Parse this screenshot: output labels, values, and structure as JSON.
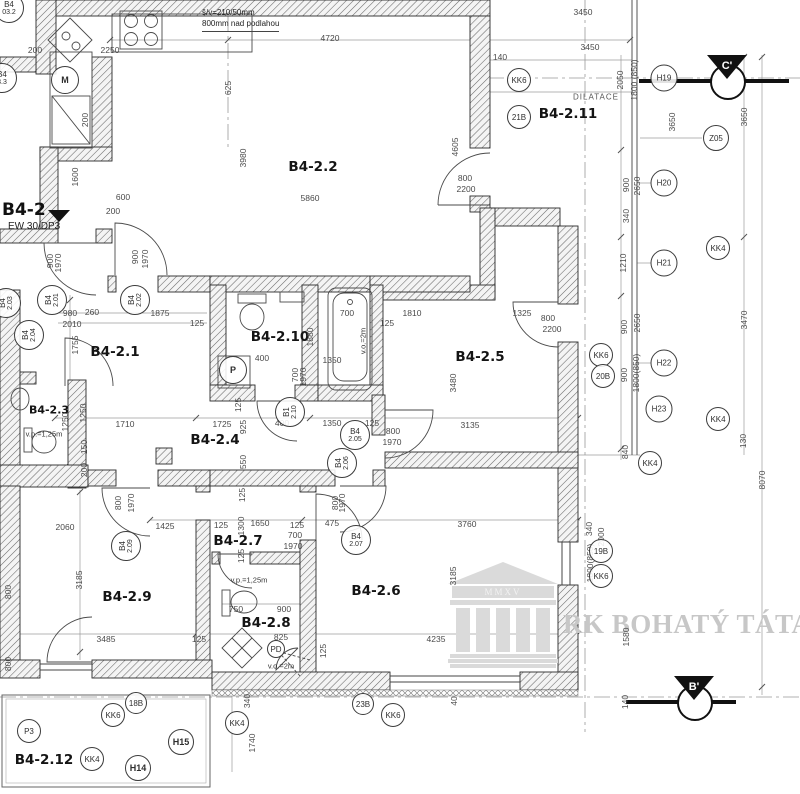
{
  "title": {
    "label": "B4-2",
    "fire_rating": "EW 30/DP3"
  },
  "note": {
    "line1": "š/v=210/50mm",
    "line2": "800mm nad podlahou"
  },
  "watermark": {
    "text": "RK BOHATÝ TÁTA",
    "inscription": "MMXV"
  },
  "section_markers": {
    "c": "C'",
    "b": "B'"
  },
  "rooms": [
    {
      "name": "room-label-b4-2-1",
      "text": "B4-2.1",
      "x": 115,
      "y": 352
    },
    {
      "name": "room-label-b4-2-2",
      "text": "B4-2.2",
      "x": 313,
      "y": 167
    },
    {
      "name": "room-label-b4-2-3",
      "text": "B4-2.3",
      "x": 49,
      "y": 410,
      "cls": "room-sm"
    },
    {
      "name": "room-label-b4-2-4",
      "text": "B4-2.4",
      "x": 215,
      "y": 440
    },
    {
      "name": "room-label-b4-2-5",
      "text": "B4-2.5",
      "x": 480,
      "y": 357
    },
    {
      "name": "room-label-b4-2-6",
      "text": "B4-2.6",
      "x": 376,
      "y": 591
    },
    {
      "name": "room-label-b4-2-7",
      "text": "B4-2.7",
      "x": 238,
      "y": 541
    },
    {
      "name": "room-label-b4-2-8",
      "text": "B4-2.8",
      "x": 266,
      "y": 623
    },
    {
      "name": "room-label-b4-2-9",
      "text": "B4-2.9",
      "x": 127,
      "y": 597
    },
    {
      "name": "room-label-b4-2-10",
      "text": "B4-2.10",
      "x": 280,
      "y": 337
    },
    {
      "name": "room-label-b4-2-11",
      "text": "B4-2.11",
      "x": 568,
      "y": 114
    },
    {
      "name": "room-label-b4-2-12",
      "text": "B4-2.12",
      "x": 44,
      "y": 760
    }
  ],
  "texts": [
    {
      "text": "DILATACE",
      "x": 596,
      "y": 97,
      "cls": "dilat"
    },
    {
      "text": "v.o.=2m",
      "x": 363,
      "y": 341,
      "rot": -90,
      "cls": "small"
    },
    {
      "text": "v.p.=1,25m",
      "x": 44,
      "y": 434,
      "cls": "small"
    },
    {
      "text": "v.p.=1,25m",
      "x": 249,
      "y": 580,
      "cls": "small"
    },
    {
      "text": "v.o.=2m",
      "x": 281,
      "y": 666,
      "cls": "small"
    }
  ],
  "dims": [
    {
      "text": "4720",
      "x": 330,
      "y": 38
    },
    {
      "text": "3450",
      "x": 583,
      "y": 12
    },
    {
      "text": "3450",
      "x": 590,
      "y": 47
    },
    {
      "text": "140",
      "x": 500,
      "y": 57
    },
    {
      "text": "2250",
      "x": 110,
      "y": 50
    },
    {
      "text": "200",
      "x": 35,
      "y": 50
    },
    {
      "text": "625",
      "x": 228,
      "y": 88,
      "rot": -90
    },
    {
      "text": "200",
      "x": 85,
      "y": 120,
      "rot": -90
    },
    {
      "text": "1600",
      "x": 75,
      "y": 177,
      "rot": -90
    },
    {
      "text": "600",
      "x": 123,
      "y": 197
    },
    {
      "text": "200",
      "x": 113,
      "y": 211
    },
    {
      "text": "5860",
      "x": 310,
      "y": 198
    },
    {
      "text": "3980",
      "x": 243,
      "y": 158,
      "rot": -90
    },
    {
      "text": "4605",
      "x": 455,
      "y": 147,
      "rot": -90
    },
    {
      "text": "800",
      "x": 465,
      "y": 178
    },
    {
      "text": "2200",
      "x": 466,
      "y": 189
    },
    {
      "text": "900",
      "x": 50,
      "y": 261,
      "rot": -90
    },
    {
      "text": "1970",
      "x": 58,
      "y": 263,
      "rot": -90
    },
    {
      "text": "900",
      "x": 135,
      "y": 257,
      "rot": -90
    },
    {
      "text": "1970",
      "x": 145,
      "y": 259,
      "rot": -90
    },
    {
      "text": "980",
      "x": 70,
      "y": 313
    },
    {
      "text": "260",
      "x": 92,
      "y": 312
    },
    {
      "text": "2010",
      "x": 72,
      "y": 324
    },
    {
      "text": "1875",
      "x": 160,
      "y": 313
    },
    {
      "text": "125",
      "x": 197,
      "y": 323
    },
    {
      "text": "1755",
      "x": 75,
      "y": 345,
      "rot": -90
    },
    {
      "text": "700",
      "x": 347,
      "y": 313
    },
    {
      "text": "1810",
      "x": 412,
      "y": 313
    },
    {
      "text": "125",
      "x": 387,
      "y": 323
    },
    {
      "text": "1880",
      "x": 310,
      "y": 337,
      "rot": -90
    },
    {
      "text": "1350",
      "x": 332,
      "y": 360
    },
    {
      "text": "1325",
      "x": 522,
      "y": 313
    },
    {
      "text": "800",
      "x": 548,
      "y": 318
    },
    {
      "text": "2200",
      "x": 552,
      "y": 329
    },
    {
      "text": "400",
      "x": 262,
      "y": 358
    },
    {
      "text": "700",
      "x": 295,
      "y": 375,
      "rot": -90
    },
    {
      "text": "1970",
      "x": 303,
      "y": 377,
      "rot": -90
    },
    {
      "text": "3480",
      "x": 453,
      "y": 383,
      "rot": -90
    },
    {
      "text": "1250",
      "x": 83,
      "y": 413,
      "rot": -90
    },
    {
      "text": "150",
      "x": 84,
      "y": 447,
      "rot": -90
    },
    {
      "text": "200",
      "x": 84,
      "y": 470,
      "rot": -90
    },
    {
      "text": "1250",
      "x": 65,
      "y": 422,
      "rot": -90
    },
    {
      "text": "1710",
      "x": 125,
      "y": 424
    },
    {
      "text": "1725",
      "x": 222,
      "y": 424
    },
    {
      "text": "925",
      "x": 243,
      "y": 427,
      "rot": -90
    },
    {
      "text": "125",
      "x": 238,
      "y": 405,
      "rot": -90
    },
    {
      "text": "400",
      "x": 282,
      "y": 423
    },
    {
      "text": "1350",
      "x": 332,
      "y": 423
    },
    {
      "text": "125",
      "x": 372,
      "y": 423
    },
    {
      "text": "800",
      "x": 393,
      "y": 431
    },
    {
      "text": "1970",
      "x": 392,
      "y": 442
    },
    {
      "text": "3135",
      "x": 470,
      "y": 425
    },
    {
      "text": "550",
      "x": 243,
      "y": 462,
      "rot": -90
    },
    {
      "text": "125",
      "x": 242,
      "y": 495,
      "rot": -90
    },
    {
      "text": "800",
      "x": 335,
      "y": 503,
      "rot": -90
    },
    {
      "text": "1970",
      "x": 342,
      "y": 503,
      "rot": -90
    },
    {
      "text": "800",
      "x": 118,
      "y": 503,
      "rot": -90
    },
    {
      "text": "1970",
      "x": 131,
      "y": 503,
      "rot": -90
    },
    {
      "text": "2060",
      "x": 65,
      "y": 527
    },
    {
      "text": "1425",
      "x": 165,
      "y": 526
    },
    {
      "text": "125",
      "x": 221,
      "y": 525
    },
    {
      "text": "1300",
      "x": 241,
      "y": 526,
      "rot": -90
    },
    {
      "text": "1650",
      "x": 260,
      "y": 523
    },
    {
      "text": "125",
      "x": 297,
      "y": 525
    },
    {
      "text": "475",
      "x": 332,
      "y": 523
    },
    {
      "text": "3760",
      "x": 467,
      "y": 524
    },
    {
      "text": "700",
      "x": 295,
      "y": 535
    },
    {
      "text": "1970",
      "x": 293,
      "y": 546
    },
    {
      "text": "3185",
      "x": 79,
      "y": 580,
      "rot": -90
    },
    {
      "text": "3185",
      "x": 453,
      "y": 576,
      "rot": -90
    },
    {
      "text": "800",
      "x": 8,
      "y": 592,
      "rot": -90
    },
    {
      "text": "800",
      "x": 8,
      "y": 664,
      "rot": -90
    },
    {
      "text": "125",
      "x": 241,
      "y": 556,
      "rot": -90
    },
    {
      "text": "750",
      "x": 236,
      "y": 609
    },
    {
      "text": "900",
      "x": 284,
      "y": 609
    },
    {
      "text": "825",
      "x": 281,
      "y": 637
    },
    {
      "text": "125",
      "x": 323,
      "y": 651,
      "rot": -90
    },
    {
      "text": "3485",
      "x": 106,
      "y": 639
    },
    {
      "text": "125",
      "x": 199,
      "y": 639
    },
    {
      "text": "4235",
      "x": 436,
      "y": 639
    },
    {
      "text": "2050",
      "x": 620,
      "y": 80,
      "rot": -90
    },
    {
      "text": "1800 (850)",
      "x": 634,
      "y": 80,
      "rot": -90
    },
    {
      "text": "3650",
      "x": 672,
      "y": 122,
      "rot": -90
    },
    {
      "text": "3650",
      "x": 744,
      "y": 117,
      "rot": -90
    },
    {
      "text": "900",
      "x": 626,
      "y": 185,
      "rot": -90
    },
    {
      "text": "2650",
      "x": 637,
      "y": 186,
      "rot": -90
    },
    {
      "text": "340",
      "x": 626,
      "y": 216,
      "rot": -90
    },
    {
      "text": "1210",
      "x": 623,
      "y": 263,
      "rot": -90
    },
    {
      "text": "900",
      "x": 624,
      "y": 327,
      "rot": -90
    },
    {
      "text": "2650",
      "x": 637,
      "y": 323,
      "rot": -90
    },
    {
      "text": "900",
      "x": 624,
      "y": 375,
      "rot": -90
    },
    {
      "text": "1800(850)",
      "x": 636,
      "y": 373,
      "rot": -90
    },
    {
      "text": "3470",
      "x": 744,
      "y": 320,
      "rot": -90
    },
    {
      "text": "130",
      "x": 743,
      "y": 441,
      "rot": -90
    },
    {
      "text": "840",
      "x": 625,
      "y": 452,
      "rot": -90
    },
    {
      "text": "8070",
      "x": 762,
      "y": 480,
      "rot": -90
    },
    {
      "text": "340",
      "x": 589,
      "y": 529,
      "rot": -90
    },
    {
      "text": "2000",
      "x": 601,
      "y": 537,
      "rot": -90
    },
    {
      "text": "1800(850)",
      "x": 590,
      "y": 563,
      "rot": -90
    },
    {
      "text": "1580",
      "x": 626,
      "y": 637,
      "rot": -90
    },
    {
      "text": "140",
      "x": 625,
      "y": 702,
      "rot": -90
    },
    {
      "text": "340",
      "x": 247,
      "y": 701,
      "rot": -90
    },
    {
      "text": "1740",
      "x": 252,
      "y": 743,
      "rot": -90
    },
    {
      "text": "40",
      "x": 454,
      "y": 701,
      "rot": -90
    }
  ],
  "markers": [
    {
      "label": "KK6",
      "x": 519,
      "y": 80,
      "d": 24
    },
    {
      "label": "21B",
      "x": 519,
      "y": 117,
      "d": 24
    },
    {
      "label": "H19",
      "x": 664,
      "y": 78,
      "d": 27
    },
    {
      "label": "Z05",
      "x": 716,
      "y": 138,
      "d": 26
    },
    {
      "label": "H20",
      "x": 664,
      "y": 183,
      "d": 27
    },
    {
      "label": "KK4",
      "x": 718,
      "y": 248,
      "d": 24
    },
    {
      "label": "H21",
      "x": 664,
      "y": 263,
      "d": 27
    },
    {
      "label": "KK6",
      "x": 601,
      "y": 355,
      "d": 24
    },
    {
      "label": "20B",
      "x": 603,
      "y": 376,
      "d": 24
    },
    {
      "label": "H22",
      "x": 664,
      "y": 363,
      "d": 27
    },
    {
      "label": "H23",
      "x": 659,
      "y": 409,
      "d": 27
    },
    {
      "label": "KK4",
      "x": 718,
      "y": 419,
      "d": 24
    },
    {
      "label": "KK4",
      "x": 650,
      "y": 463,
      "d": 24
    },
    {
      "label": "19B",
      "x": 601,
      "y": 551,
      "d": 24
    },
    {
      "label": "KK6",
      "x": 601,
      "y": 576,
      "d": 24
    },
    {
      "label": "23B",
      "x": 363,
      "y": 704,
      "d": 22
    },
    {
      "label": "KK6",
      "x": 393,
      "y": 715,
      "d": 24
    },
    {
      "label": "18B",
      "x": 136,
      "y": 703,
      "d": 22
    },
    {
      "label": "KK6",
      "x": 113,
      "y": 715,
      "d": 24
    },
    {
      "label": "P3",
      "x": 29,
      "y": 731,
      "d": 24
    },
    {
      "label": "KK4",
      "x": 92,
      "y": 759,
      "d": 24
    },
    {
      "label": "H14",
      "x": 138,
      "y": 768,
      "d": 26,
      "b": true
    },
    {
      "label": "H15",
      "x": 181,
      "y": 742,
      "d": 26,
      "b": true
    },
    {
      "label": "KK4",
      "x": 237,
      "y": 723,
      "d": 24
    },
    {
      "label": "M",
      "x": 65,
      "y": 80,
      "d": 28,
      "b": true
    },
    {
      "label": "P",
      "x": 233,
      "y": 370,
      "d": 28,
      "b": true
    },
    {
      "label": "PD",
      "x": 276,
      "y": 649,
      "d": 18
    }
  ],
  "door_markers": [
    {
      "top": "B4",
      "bottom": "2.01",
      "x": 52,
      "y": 300,
      "rot": -90
    },
    {
      "top": "B4",
      "bottom": "2.02",
      "x": 135,
      "y": 300,
      "rot": -90
    },
    {
      "top": "B4",
      "bottom": "2.03",
      "x": 6,
      "y": 303,
      "rot": -90
    },
    {
      "top": "B4",
      "bottom": "2.04",
      "x": 29,
      "y": 335,
      "rot": -90
    },
    {
      "top": "B4",
      "bottom": "2.05",
      "x": 355,
      "y": 435,
      "rot": 0
    },
    {
      "top": "B4",
      "bottom": "2.06",
      "x": 342,
      "y": 463,
      "rot": -90
    },
    {
      "top": "B4",
      "bottom": "2.07",
      "x": 356,
      "y": 540,
      "rot": 0
    },
    {
      "top": "B4",
      "bottom": "2.09",
      "x": 126,
      "y": 546,
      "rot": -90
    },
    {
      "top": "B1",
      "bottom": "2.10",
      "x": 290,
      "y": 412,
      "rot": -90
    },
    {
      "top": "B4",
      "bottom": "03.2",
      "x": 9,
      "y": 8,
      "rot": 0
    },
    {
      "top": "B4",
      "bottom": "3.3",
      "x": 2,
      "y": 78,
      "rot": 0
    }
  ]
}
